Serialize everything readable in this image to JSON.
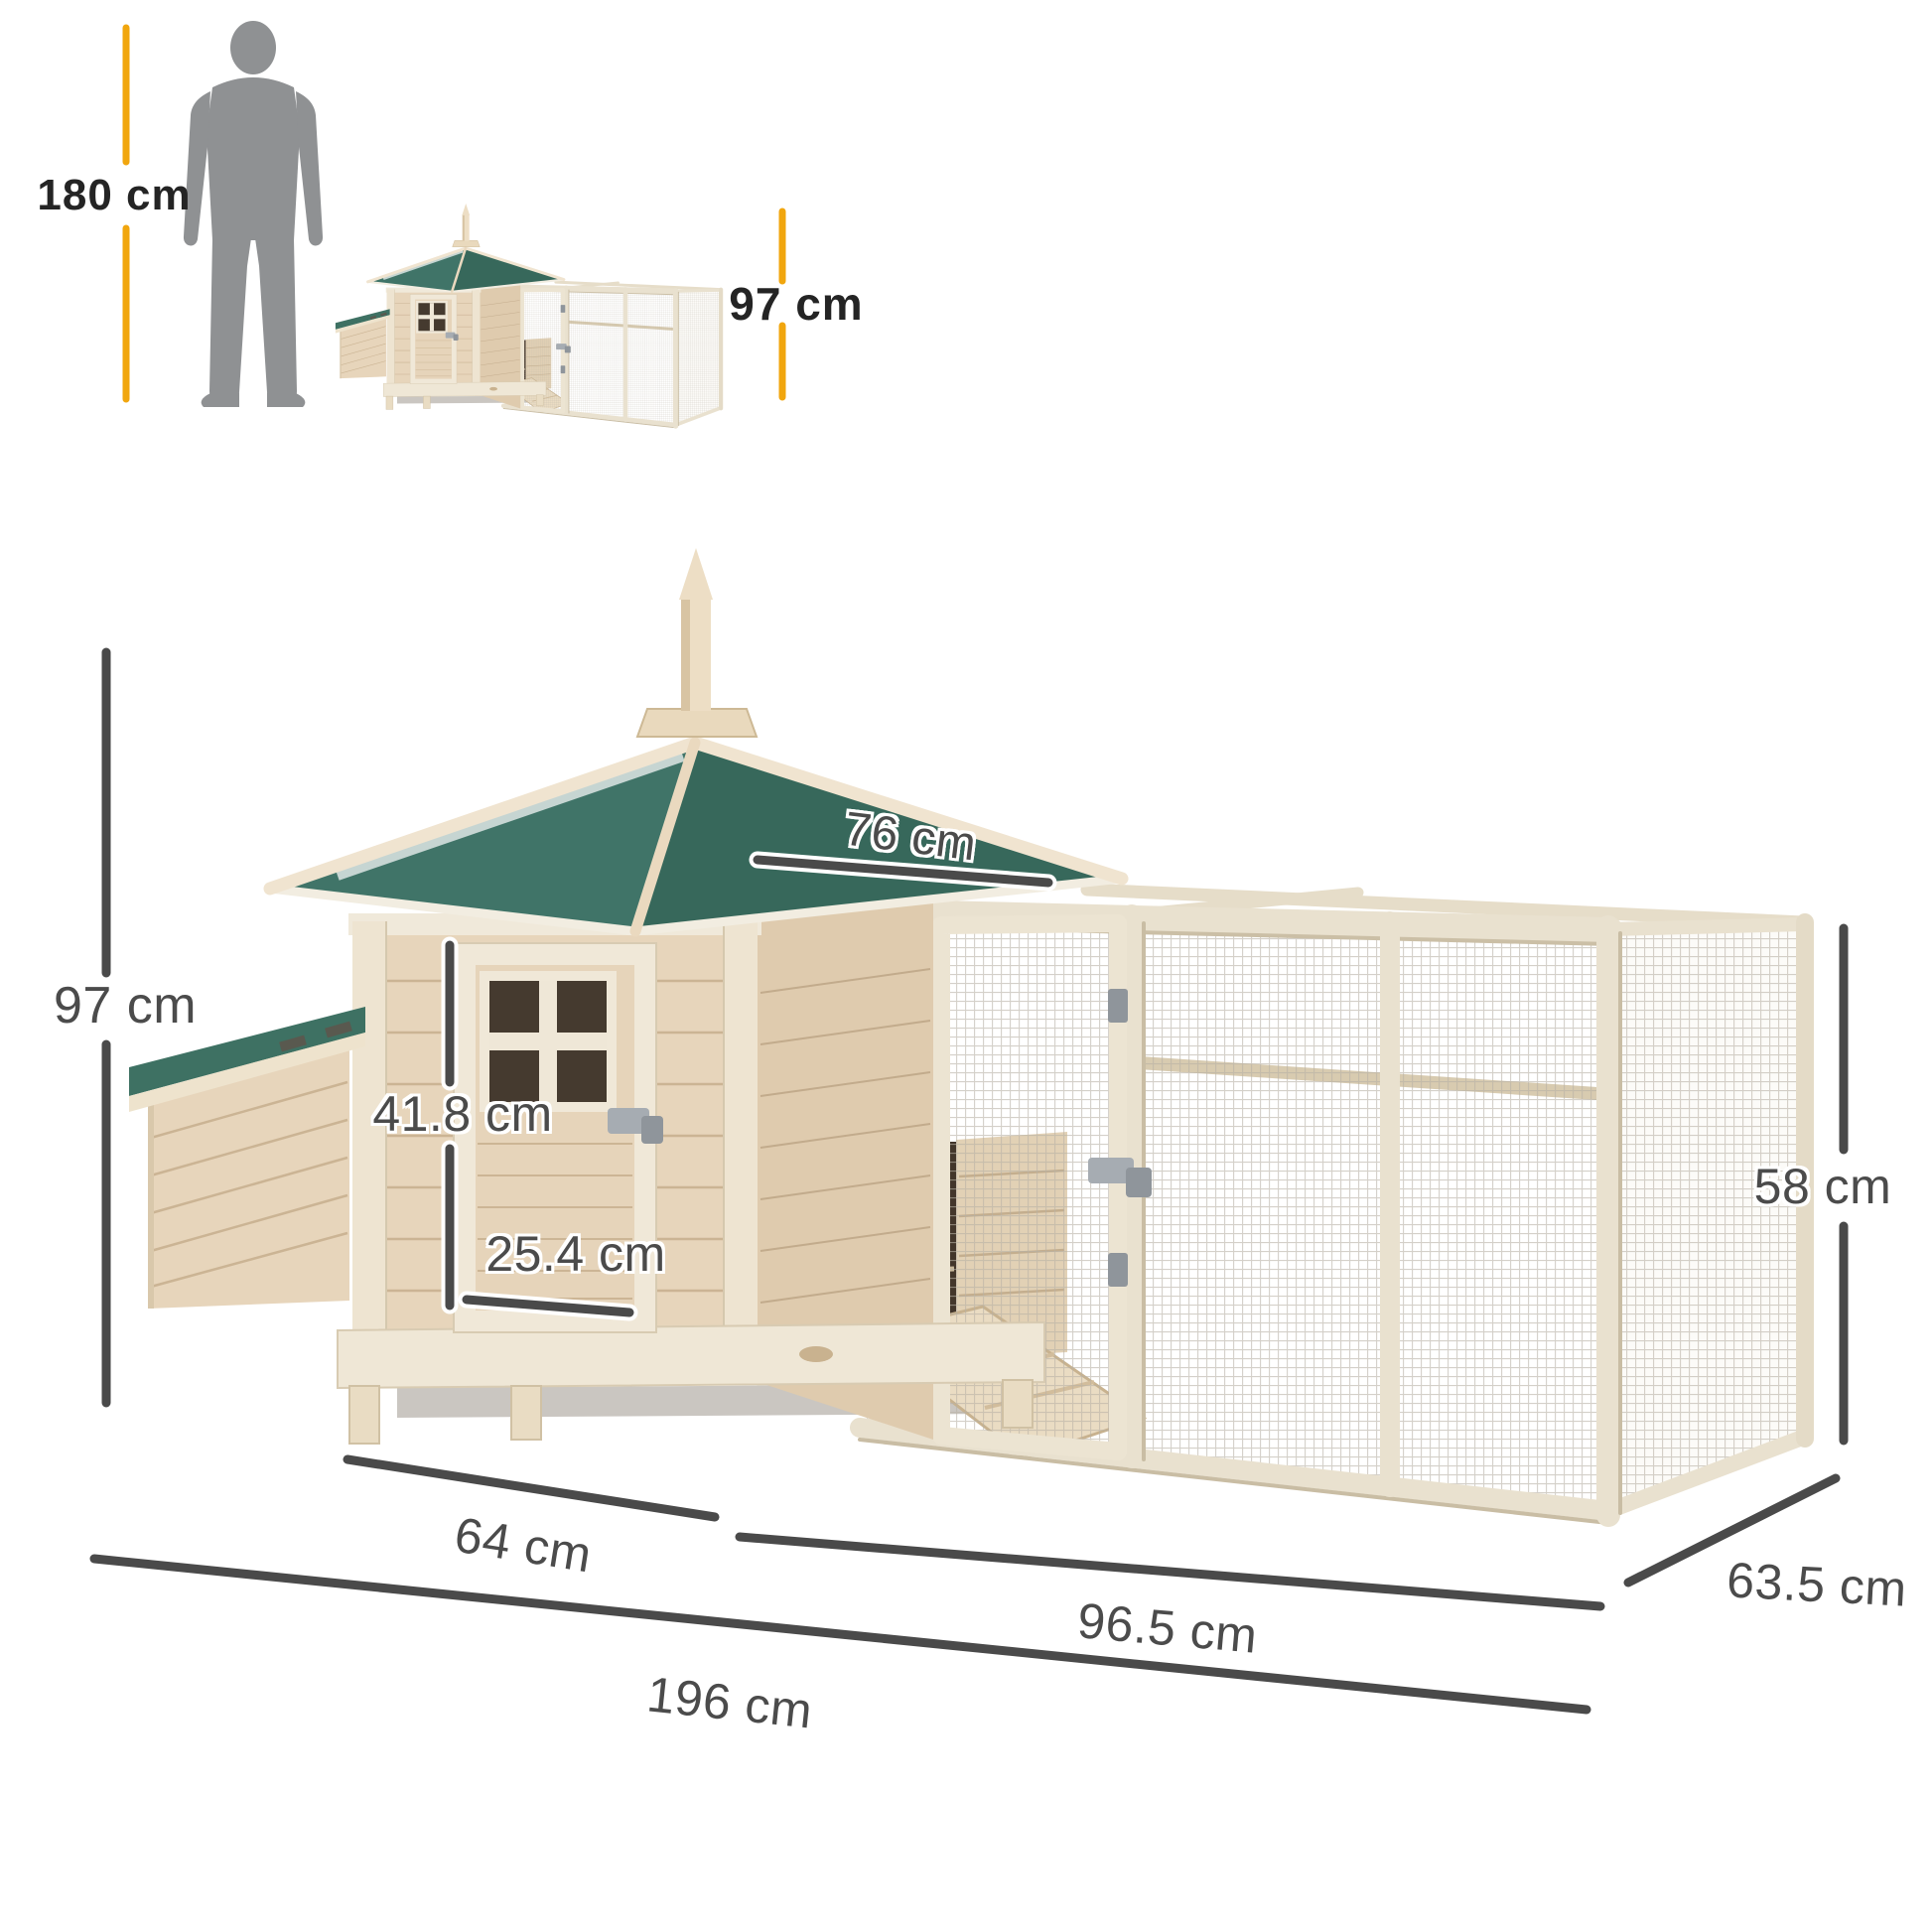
{
  "labels": {
    "person_height": "180 cm",
    "mini_product_height": "97 cm",
    "overall_height": "97 cm",
    "roof_length": "76 cm",
    "door_height": "41.8 cm",
    "door_width": "25.4 cm",
    "run_height": "58 cm",
    "house_length": "64 cm",
    "run_length": "96.5 cm",
    "overall_length": "196 cm",
    "depth": "63.5 cm"
  },
  "colors": {
    "background": "#FFFFFF",
    "accent_yellow": "#F1A60E",
    "dimension_gray": "#4A4A4A",
    "label_black": "#242424",
    "roof_green": "#3E7163",
    "roof_green_dark": "#37685B",
    "wood_light": "#E7D5BB",
    "trim_cream": "#F0E8D8",
    "silhouette_gray": "#8F9193"
  },
  "icons": {
    "person_silhouette": "standing man used as height scale reference"
  }
}
